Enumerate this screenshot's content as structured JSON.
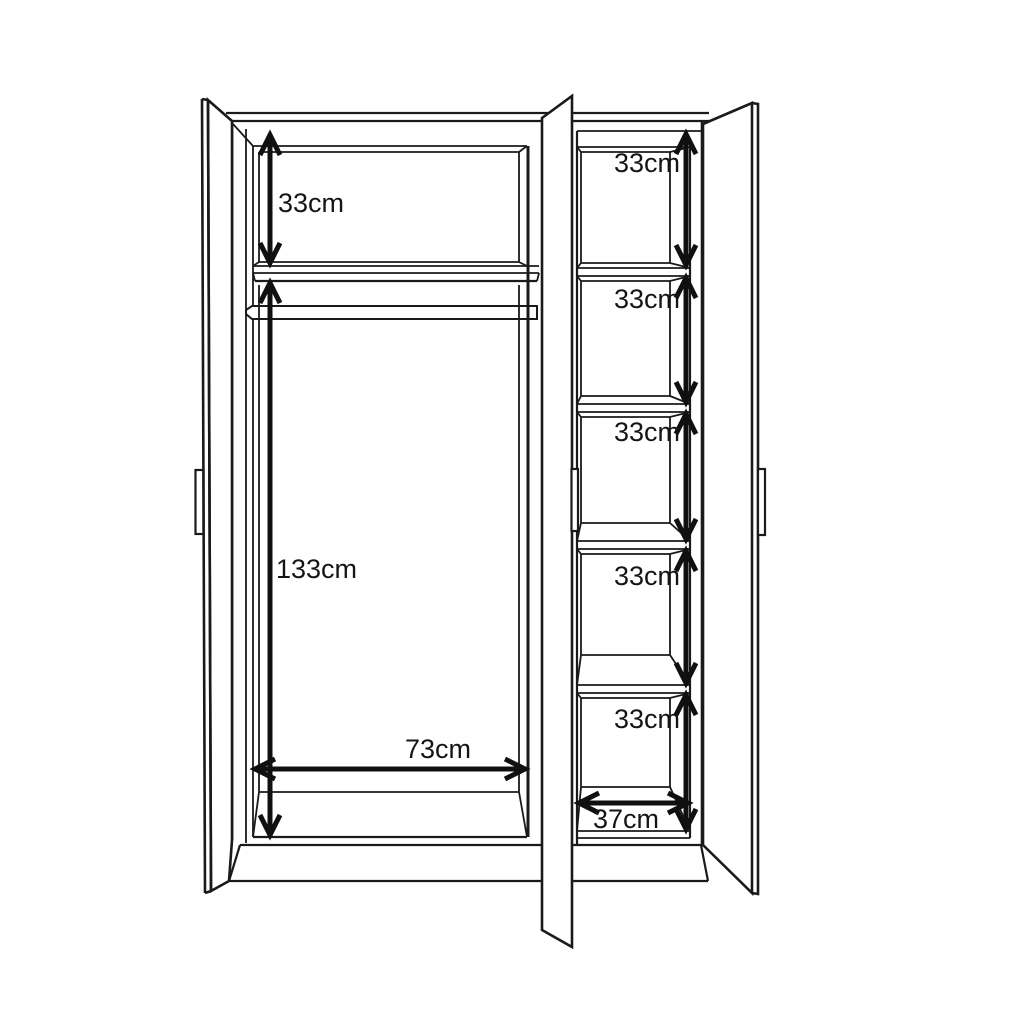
{
  "diagram": {
    "type": "wardrobe-dimension-drawing",
    "background_color": "#ffffff",
    "line_color": "#1a1a1a",
    "arrow_color": "#101010",
    "left_section": {
      "top_compartment_height_label": "33cm",
      "hanging_area_height_label": "133cm",
      "width_label": "73cm"
    },
    "right_section": {
      "compartment_height_labels": [
        "33cm",
        "33cm",
        "33cm",
        "33cm",
        "33cm"
      ],
      "width_label": "37cm"
    }
  }
}
